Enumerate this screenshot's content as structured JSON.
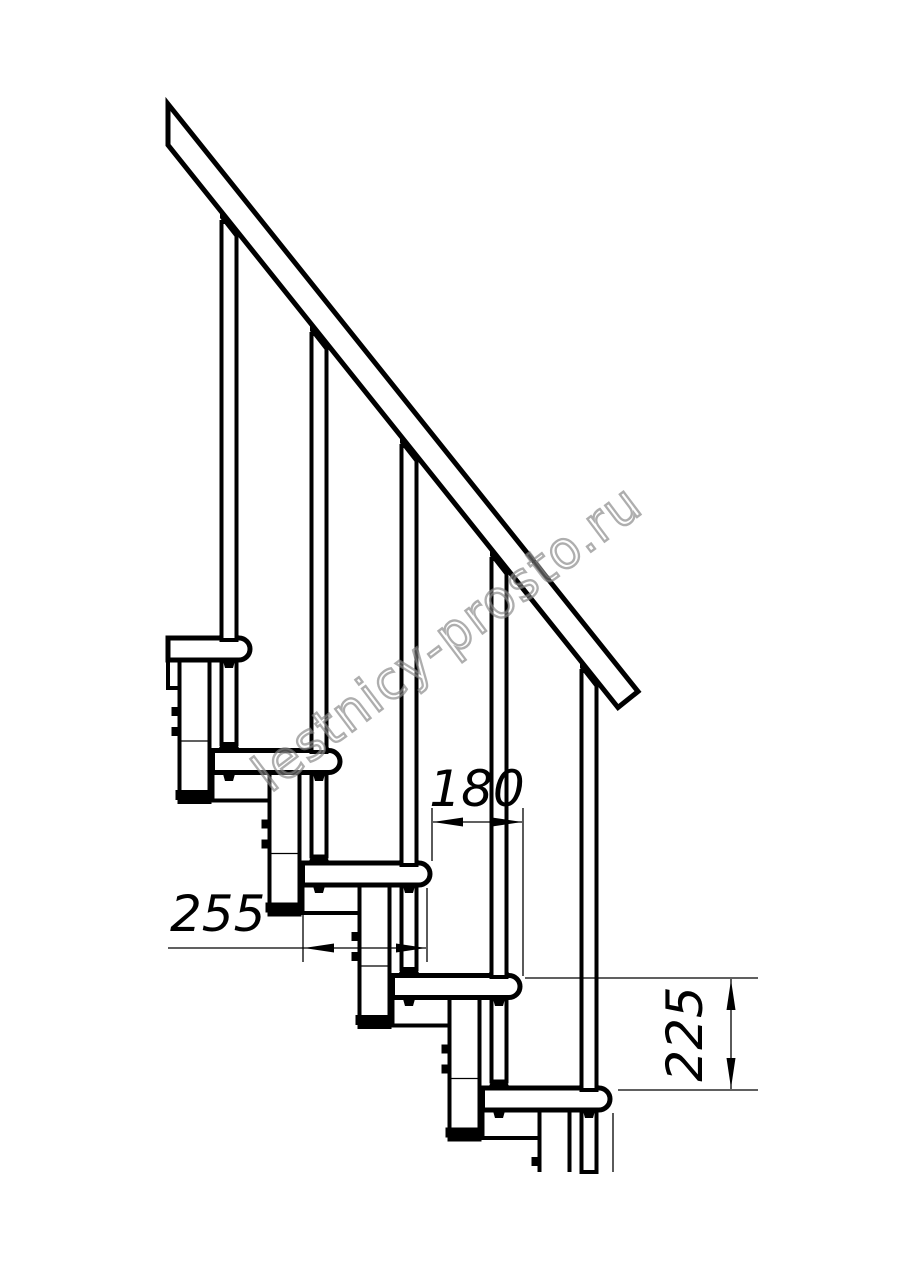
{
  "diagram": {
    "name": "staircase-side-view-technical-drawing",
    "type": "technical-drawing",
    "tread_count": 5,
    "baluster_count": 5,
    "line_color": "#000000",
    "background_color": "#ffffff"
  },
  "dims": {
    "run": {
      "value": "180",
      "meaning": "horizontal step run"
    },
    "depth": {
      "value": "255",
      "meaning": "tread depth"
    },
    "rise": {
      "value": "225",
      "meaning": "riser height"
    }
  },
  "watermark": {
    "text": "lestnicy-prosto.ru",
    "color": "#828282"
  }
}
